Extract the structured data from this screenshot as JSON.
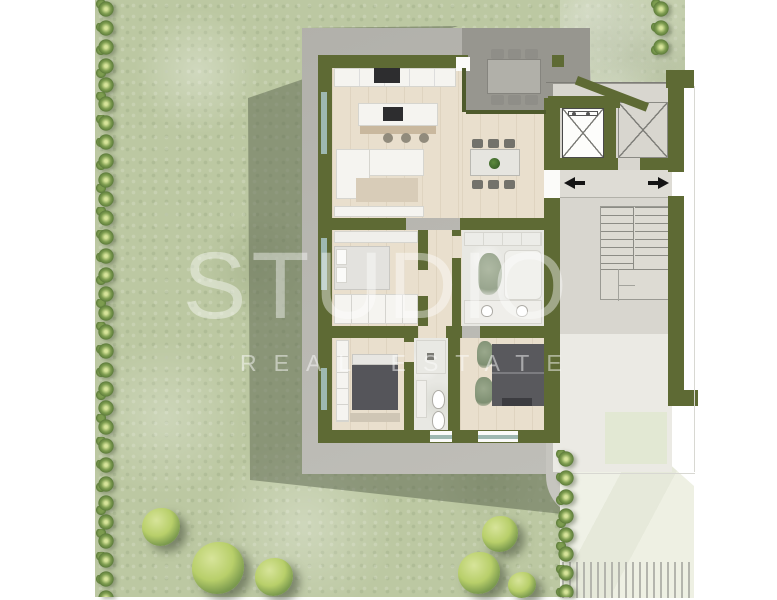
{
  "watermark": {
    "line1": "STUDIO",
    "line2": "REAL ESTATE"
  },
  "colors": {
    "page_bg": "#ffffff",
    "lawn": "#bcc8a2",
    "hedge": "#7d9c4f",
    "hedge_dark": "#5f7e3c",
    "tree": "#b8cf6a",
    "tree_light": "#d7e49a",
    "wall": "#5e6a34",
    "wall_dark": "#4e5a2c",
    "glass": "#9eb8b1",
    "terrace_dark": "#97968f",
    "path": "#c6c5bf",
    "core_floor": "#d8d6cf",
    "core_floor_lower": "#ebeae4",
    "entry_floor": "#dedcd5",
    "pale_pad": "#e2e8d3",
    "pavement": "#e9ecdf",
    "hatch": "#b4b5ad",
    "wood_floor": "#e9dfcd",
    "marble": "#e8e8e3",
    "white_furn": "#f5f4f0",
    "dark_furn": "#55555a",
    "chair": "#73726b",
    "rug": "#d8ccb8",
    "wood_bar": "#c9b89e",
    "arrow": "#141414",
    "watermark": "#ffffff"
  }
}
